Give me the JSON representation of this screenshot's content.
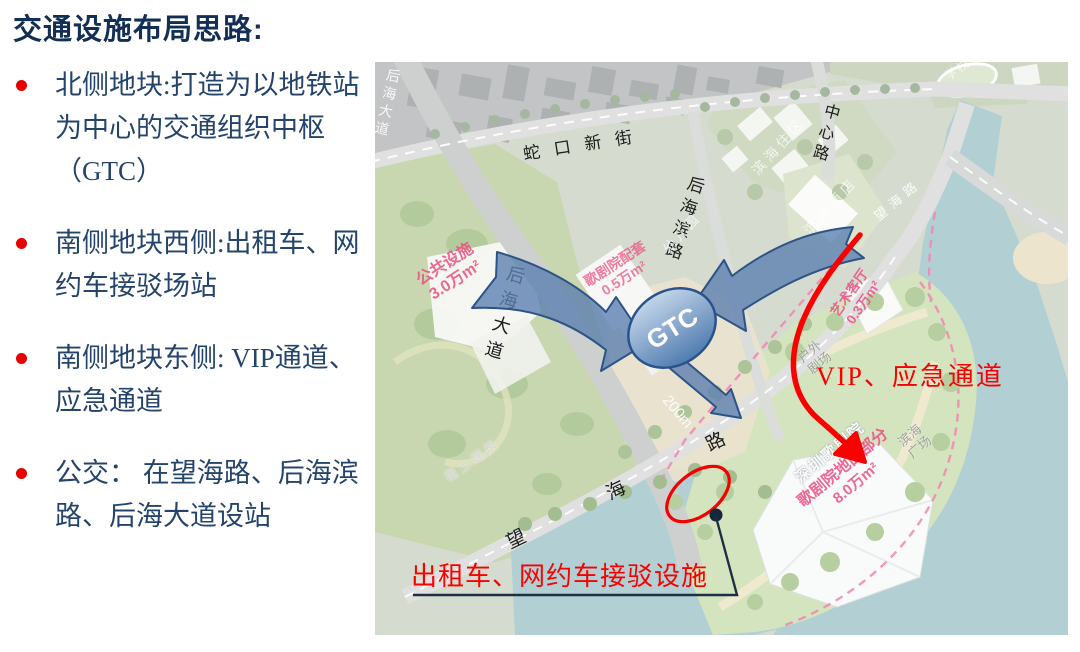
{
  "panel": {
    "title": "交通设施布局思路:",
    "bullets": [
      "北侧地块:打造为以地铁站为中心的交通组织中枢（GTC）",
      "南侧地块西侧:出租车、网约车接驳场站",
      "南侧地块东侧: VIP通道、应急通道",
      "公交： 在望海路、后海滨路、后海大道设站"
    ]
  },
  "map": {
    "roads": {
      "shekou_new_street": "蛇口新街",
      "center_road": "中心路",
      "houhai_bin_road": "后海滨路",
      "houhai_avenue": "后海大道",
      "houhai_avenue_top": "后海大道",
      "wanghai_road": "望海路",
      "wanghai_road_small": "望海路"
    },
    "places": {
      "binhai_residential": "滨海住区",
      "binhai_hotel": "滨海酒店",
      "kindergarten": "幼儿园",
      "school": "学校",
      "covered_building": "覆土建筑",
      "outdoor_theater": {
        "lines": [
          "户外",
          "剧场"
        ]
      },
      "binhai_plaza": {
        "lines": [
          "滨海",
          "广场"
        ]
      },
      "distance_marker": "200m"
    },
    "areas": {
      "public_facility": {
        "lines": [
          "公共设施",
          "3.0万m²"
        ]
      },
      "opera_support": {
        "lines": [
          "歌剧院配套",
          "0.5万m²"
        ]
      },
      "art_lounge": {
        "lines": [
          "艺术客厅",
          "0.3万m²"
        ]
      },
      "opera_house": {
        "lines": [
          "深圳歌剧院",
          "歌剧院地面部分",
          "8.0万m²"
        ]
      }
    },
    "annotations": {
      "gtc": "GTC",
      "vip_channel": "VIP、应急通道",
      "taxi_facility": "出租车、网约车接驳设施"
    },
    "colors": {
      "accent_red": "#fa0000",
      "arrow_blue": "#5d7fb0",
      "water": "#a2c6ca",
      "pink": "#e94f81",
      "panel_text": "#24446b"
    }
  }
}
